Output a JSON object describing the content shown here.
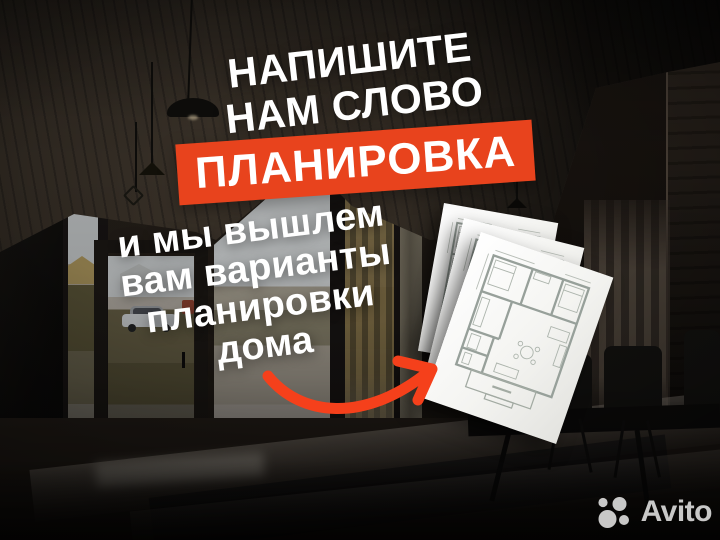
{
  "headline": {
    "line1": "НАПИШИТЕ",
    "line2": "НАМ СЛОВО"
  },
  "banner": {
    "keyword": "ПЛАНИРОВКА",
    "background_color": "#E8431D",
    "text_color": "#FFFFFF"
  },
  "subheadline": {
    "line1": "и мы вышлем",
    "line2": "вам варианты",
    "line3": "планировки",
    "line4": "дома"
  },
  "graphics": {
    "arrow_color": "#F5401B",
    "floor_plan_sheet_count": 3
  },
  "watermark": {
    "brand": "Avito"
  }
}
